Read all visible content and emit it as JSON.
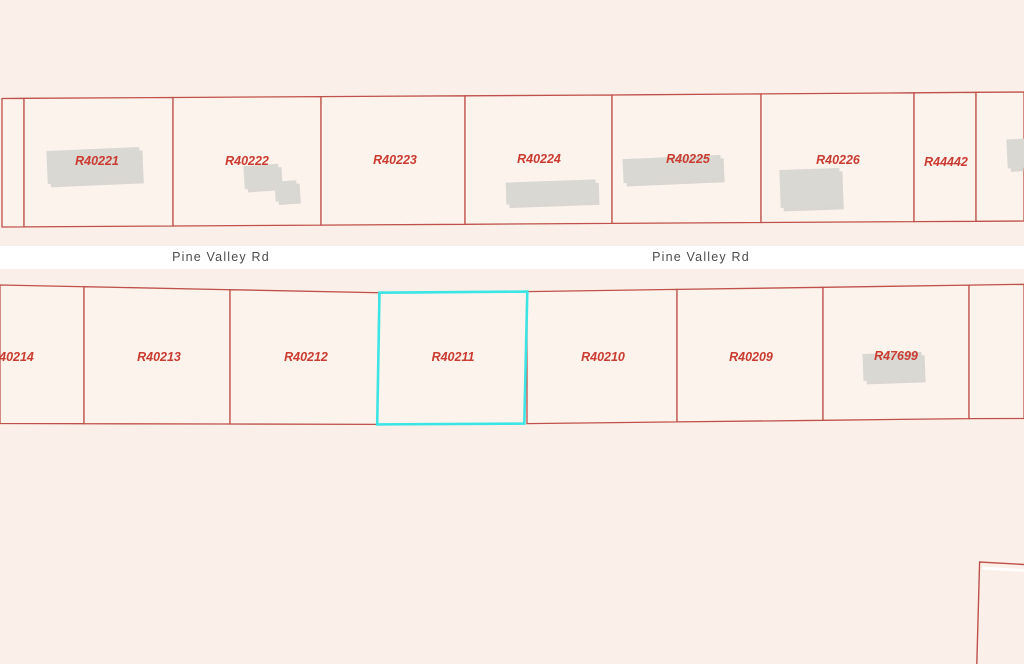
{
  "road": {
    "name": "Pine Valley Rd"
  },
  "parcels": {
    "selected_id": "R40211",
    "top": [
      {
        "id": "R40221"
      },
      {
        "id": "R40222"
      },
      {
        "id": "R40223"
      },
      {
        "id": "R40224"
      },
      {
        "id": "R40225"
      },
      {
        "id": "R40226"
      },
      {
        "id": "R44442"
      }
    ],
    "bottom": [
      {
        "id": "R40214"
      },
      {
        "id": "R40213"
      },
      {
        "id": "R40212"
      },
      {
        "id": "R40211"
      },
      {
        "id": "R40210"
      },
      {
        "id": "R40209"
      },
      {
        "id": "R47699"
      }
    ]
  },
  "colors": {
    "background": "#faf0e9",
    "parcel_fill": "#fcf3ed",
    "boundary": "#c0504a",
    "parcel_label": "#cb3b30",
    "selected_outline": "#3ce5e5",
    "building_fill": "#d9d8d3",
    "building_shadow": "#c7c6c1",
    "road_fill": "#ffffff",
    "road_text": "#4c4c4c"
  }
}
